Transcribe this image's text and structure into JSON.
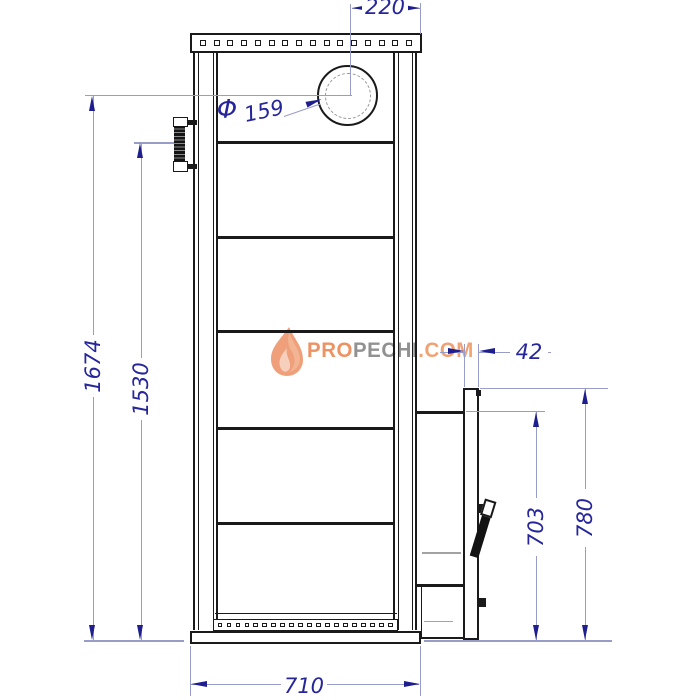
{
  "dims": {
    "top_width": "220",
    "flue_dia_prefix": "Φ",
    "flue_dia": "159",
    "overall_height": "1674",
    "inner_height": "1530",
    "door_frame_depth": "42",
    "firebox_height": "703",
    "door_panel_height": "780",
    "base_width": "710"
  },
  "watermark": {
    "part1": "PRO",
    "part2": "PECHI",
    "part3": ".COM",
    "icon": "flame-icon"
  },
  "stove": {
    "top_flange_hole_count": 16,
    "base_strip_hole_count": 20
  },
  "colors": {
    "line": "#1a1a1a",
    "dim_line": "#979cc9",
    "dim_text": "#26269a",
    "arrow": "#1e1e8f",
    "gray_line": "#a3a3a3",
    "wm_orange": "#ec9263",
    "wm_gray": "#919191",
    "wm_orange_light": "#f0a274"
  }
}
